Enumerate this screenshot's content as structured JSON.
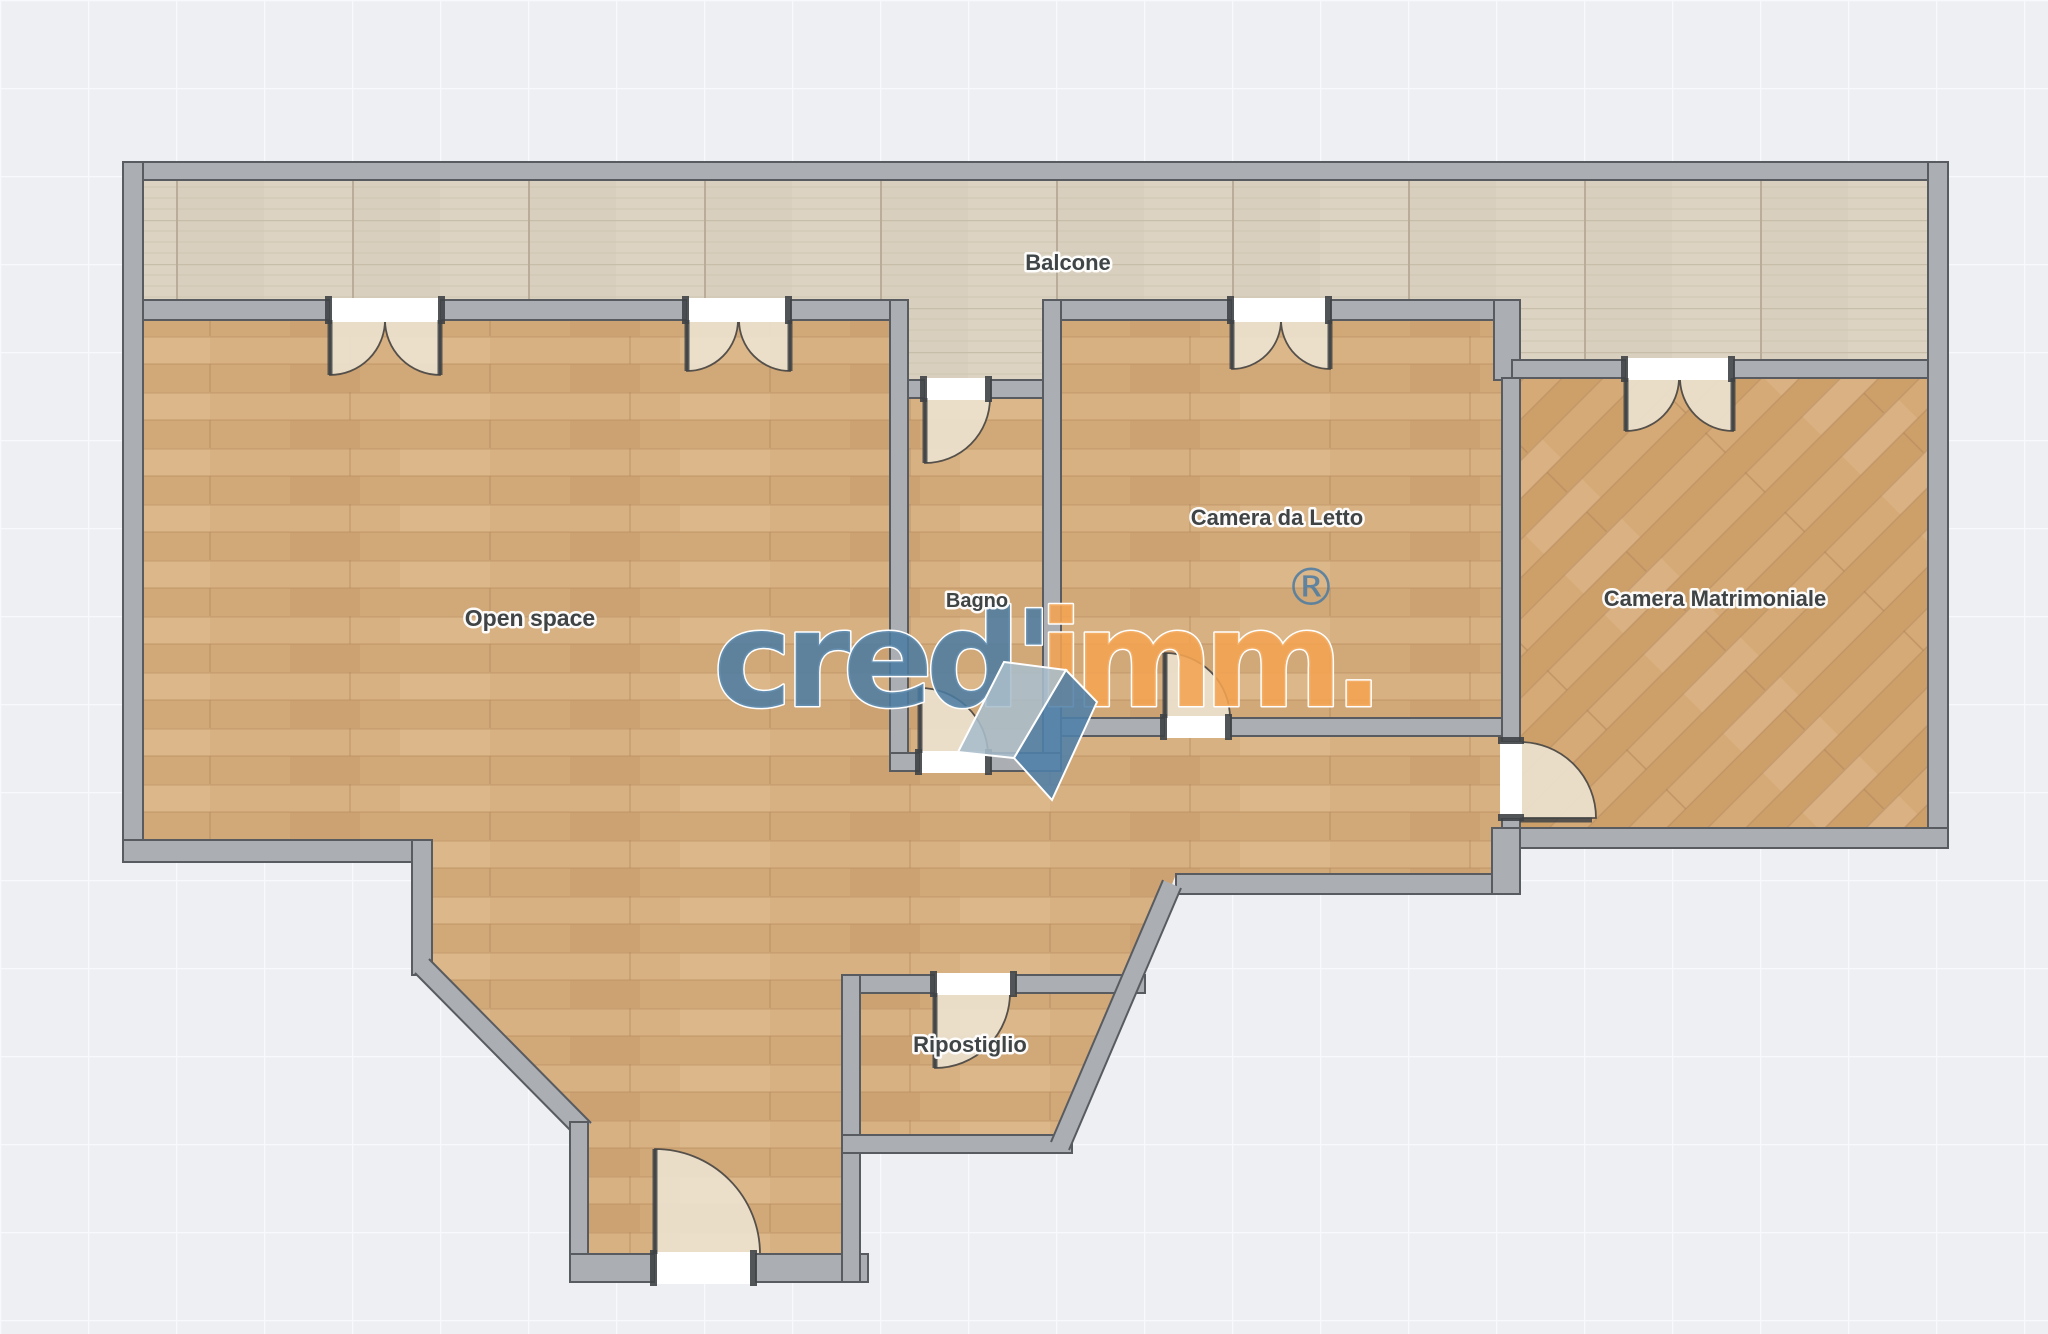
{
  "plan": {
    "type": "apartment-floor-plan",
    "rooms": [
      {
        "id": "balcone",
        "label": "Balcone"
      },
      {
        "id": "open-space",
        "label": "Open space"
      },
      {
        "id": "bagno",
        "label": "Bagno"
      },
      {
        "id": "camera-da-letto",
        "label": "Camera da Letto"
      },
      {
        "id": "camera-matrimoniale",
        "label": "Camera Matrimoniale"
      },
      {
        "id": "ripostiglio",
        "label": "Ripostiglio"
      }
    ]
  },
  "watermark": {
    "word_left": "cred'",
    "word_right": "imm.",
    "registered": "®",
    "blue": "#4A7BA2",
    "orange": "#F2A351"
  },
  "colors": {
    "background": "#edeff3",
    "grid_line": "#f8f9fc",
    "wall_fill": "#abaeb3",
    "wall_edge": "#585c61",
    "wood_floor": "#d4ab7d",
    "wood_floor_diagonal": "#d0a371",
    "balcony_tile": "#dcd3c3",
    "door_arc": "#ece2cf",
    "door_opening": "#ffffff",
    "label_text": "#3a4043"
  }
}
